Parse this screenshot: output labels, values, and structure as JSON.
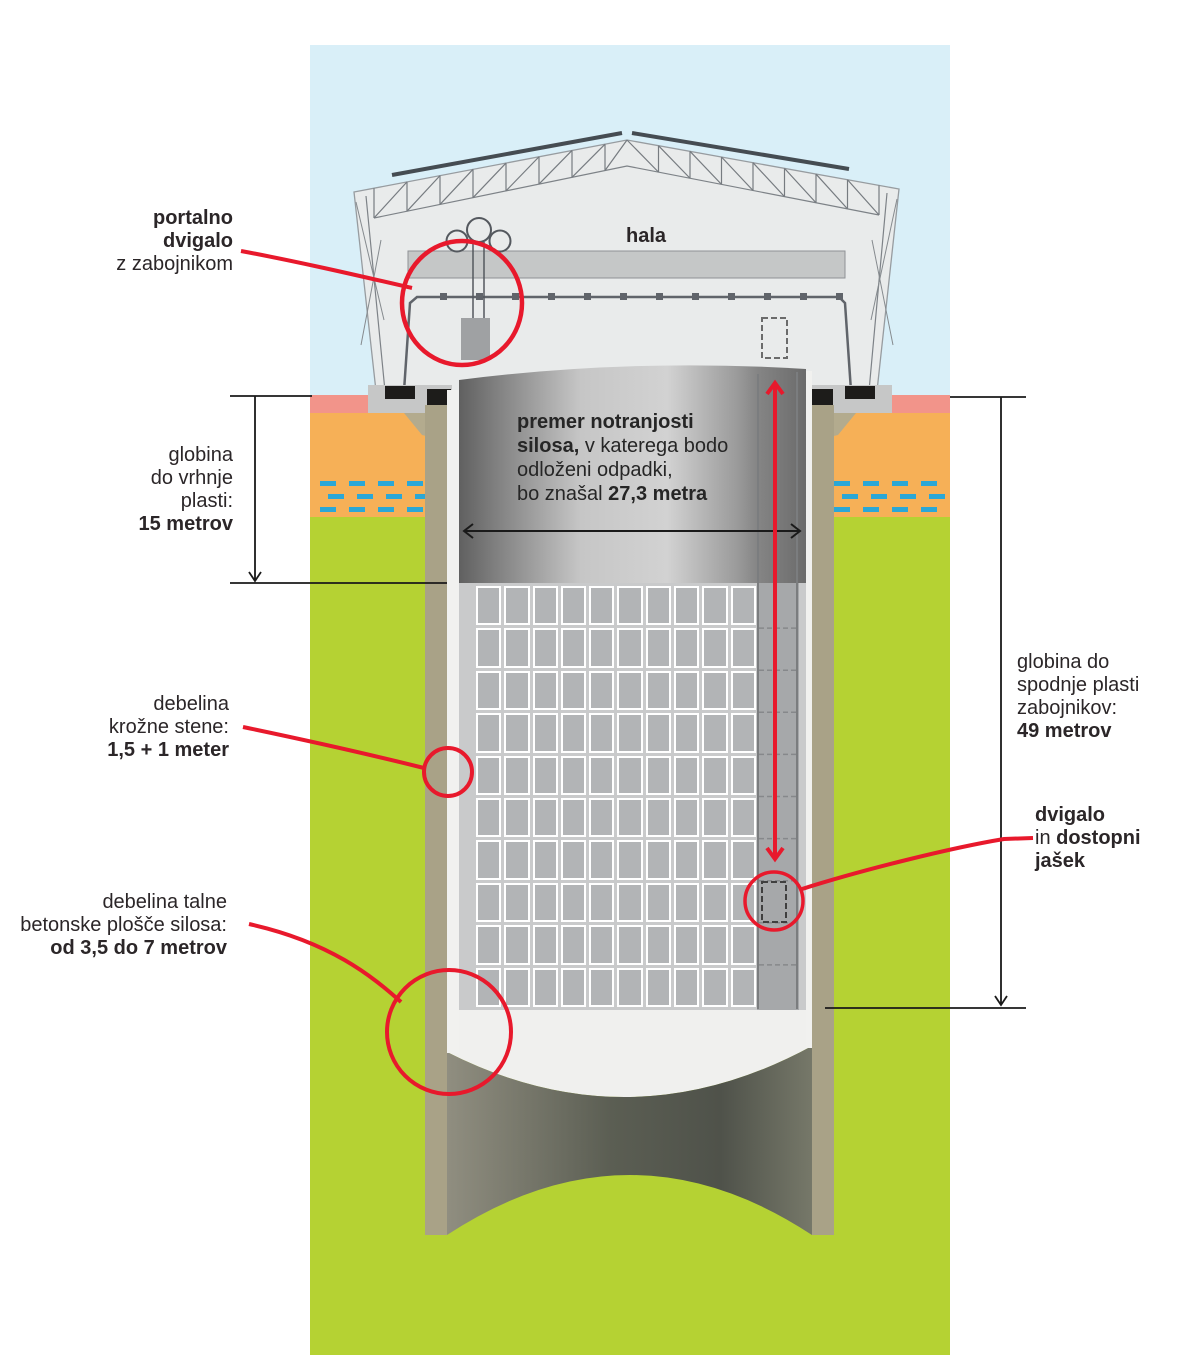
{
  "title": "silo repository cross-section diagram",
  "annotations": {
    "portal_crane": {
      "line1": "portalno",
      "line2": "dvigalo",
      "line3": "z zabojnikom"
    },
    "hall": {
      "label": "hala"
    },
    "depth_top": {
      "line1": "globina",
      "line2": "do vrhnje",
      "line3": "plasti:",
      "value": "15 metrov"
    },
    "diameter": {
      "bold1": "premer notranjosti",
      "bold2": "silosa,",
      "reg2": " v katerega bodo",
      "reg3": "odloženi odpadki,",
      "reg4": "bo znašal ",
      "bold4": "27,3 metra"
    },
    "wall_thickness": {
      "line1": "debelina",
      "line2": "krožne stene:",
      "value": "1,5 + 1 meter"
    },
    "floor_thickness": {
      "line1": "debelina talne",
      "line2": "betonske plošče silosa:",
      "value": "od 3,5 do 7 metrov"
    },
    "depth_bottom": {
      "line1": "globina do",
      "line2": "spodnje plasti",
      "line3": "zabojnikov:",
      "value": "49 metrov"
    },
    "shaft": {
      "bold1": "dvigalo",
      "reg2": "in ",
      "bold2": "dostopni",
      "bold3": "jašek"
    }
  },
  "silo": {
    "container_grid": {
      "rows": 10,
      "columns": 10
    }
  },
  "colors": {
    "accent_red": "#e8192c",
    "sky_blue": "#d9eff8",
    "topsoil_pink": "#f2948a",
    "soil_orange": "#f6b057",
    "groundwater_blue": "#2ba7d6",
    "rock_green": "#b5d233",
    "wall_tan": "#a9a287"
  }
}
